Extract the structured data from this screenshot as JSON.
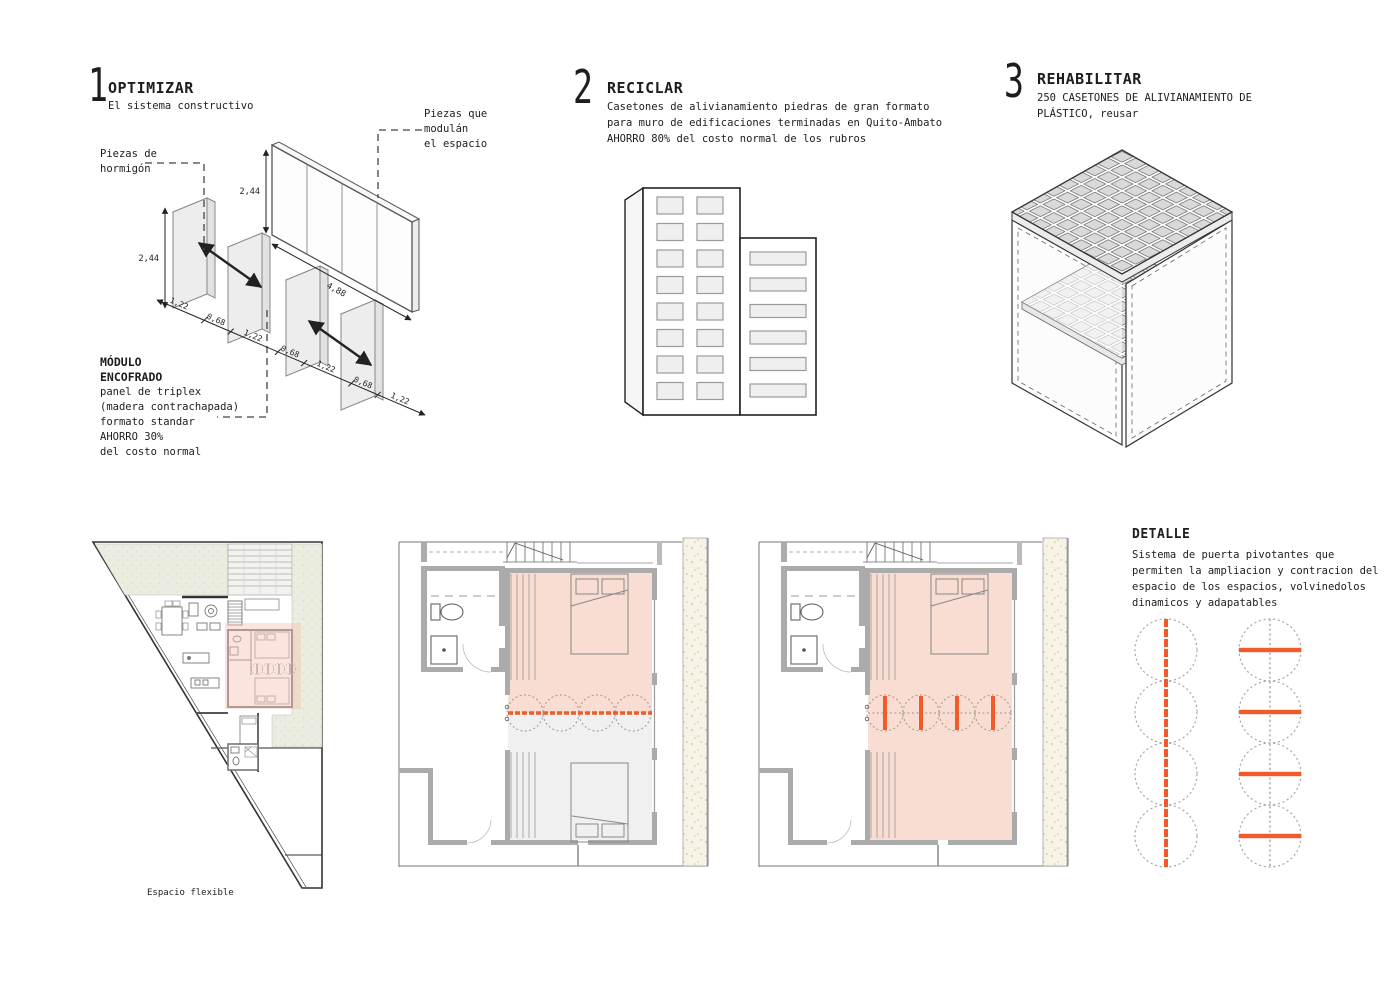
{
  "colors": {
    "accent_orange": "#f15a29",
    "pink_highlight": "#f9dcd2",
    "plan_gray": "#f0f0f0",
    "wall_gray": "#ababab",
    "site_green": "#eaeddf",
    "stipple_beige": "#f7f3e6",
    "line_dark": "#222222"
  },
  "sections": {
    "optimizar": {
      "number": "1",
      "title": "OPTIMIZAR",
      "subtitle": "El sistema constructivo",
      "label_hormigon_l1": "Piezas de",
      "label_hormigon_l2": "hormigón",
      "label_modulan_l1": "Piezas que",
      "label_modulan_l2": "modulán",
      "label_modulan_l3": "el espacio",
      "module_title_l1": "MÓDULO",
      "module_title_l2": "ENCOFRADO",
      "module_l1": "panel de triplex",
      "module_l2": "(madera contrachapada)",
      "module_l3": "formato standar",
      "module_l4": "AHORRO 30%",
      "module_l5": "del costo normal",
      "dim_panel_height": "2,44",
      "dim_wall_height": "2,44",
      "dim_wall_length": "4,88",
      "dim_sequence": [
        "1,22",
        "0,68",
        "1,22",
        "0,68",
        "1,22",
        "0,68",
        "1,22"
      ]
    },
    "reciclar": {
      "number": "2",
      "title": "RECICLAR",
      "line1": "Casetones de alivianamiento piedras de gran formato",
      "line2": "para muro de edificaciones terminadas en Quito-Ambato",
      "line3": "AHORRO 80% del costo normal de los rubros"
    },
    "rehabilitar": {
      "number": "3",
      "title": "REHABILITAR",
      "line1": "250 CASETONES DE ALIVIANAMIENTO DE",
      "line2": "PLÁSTICO, reusar"
    },
    "detalle": {
      "title": "DETALLE",
      "line1": "Sistema de puerta pivotantes que",
      "line2": "permiten la ampliacion y contracion del",
      "line3": "espacio de los espacios, volvinedolos",
      "line4": "dinamicos y adapatables"
    }
  },
  "site_plan": {
    "label": "Espacio flexible"
  }
}
